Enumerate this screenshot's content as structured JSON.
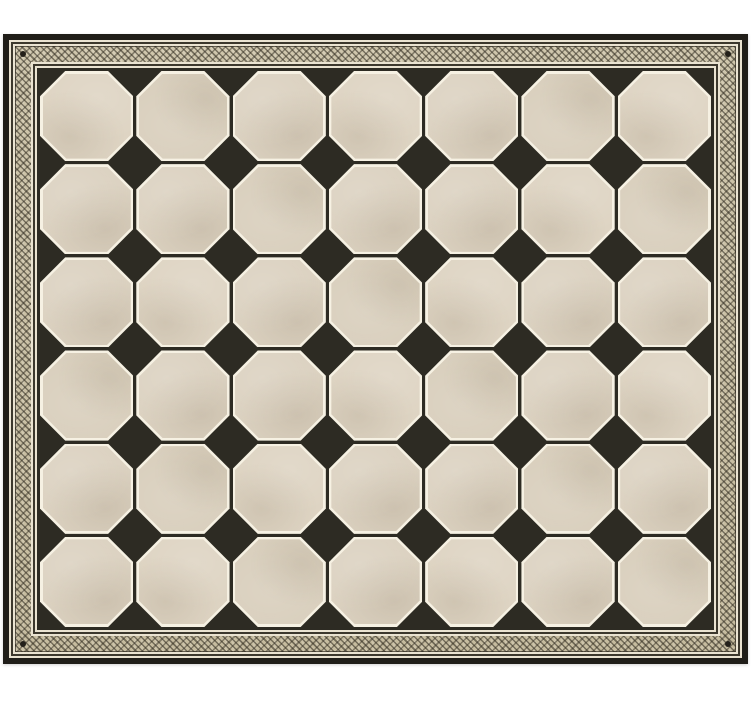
{
  "window": {
    "width": 752,
    "height": 703,
    "background": "#ffffff"
  },
  "mat": {
    "left": 3,
    "top": 34,
    "width": 745,
    "height": 630,
    "frame": {
      "outer_band_color": "#201e19",
      "pinstripe_light": "#eae3d1",
      "pinstripe_dark": "#3c382d",
      "ornament_base": "#cfc6ac",
      "ornament_mark": "#3f3a2c",
      "corner_dot": "#23201a"
    },
    "field": {
      "background": "#2d2b23",
      "octagon_fill": "#dbd1c0",
      "octagon_outline": "#f6f1e3",
      "diamond_fill": "#2d2b23",
      "grid": {
        "columns": 7,
        "rows": 6,
        "octagon_count": 42,
        "interior_diamond_count": 30
      }
    }
  }
}
